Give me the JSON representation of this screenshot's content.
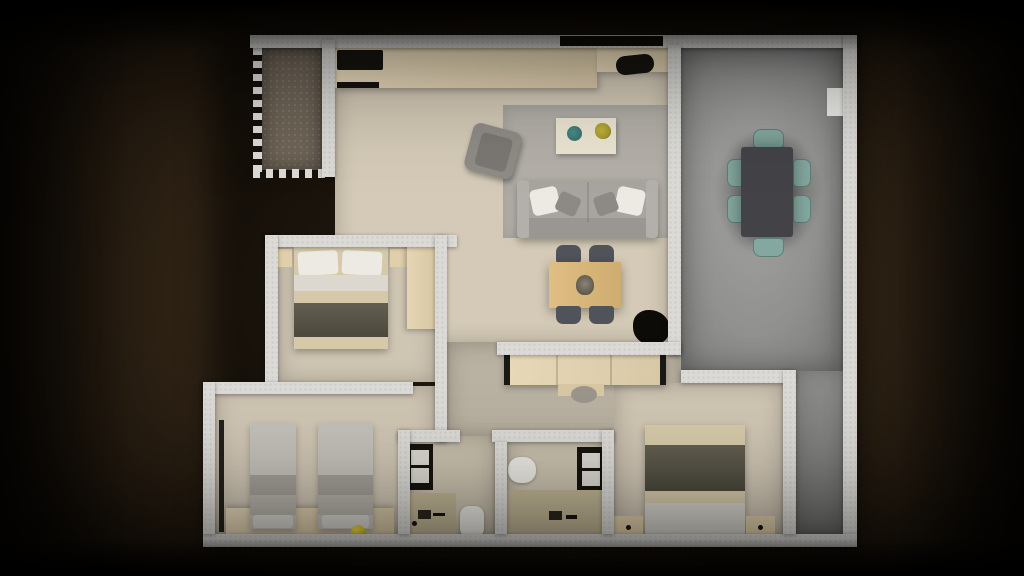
{
  "scene": {
    "title": "Top-down 3D rendered apartment floor plan on a dark brown background",
    "view": "top-down",
    "visible_text": "none"
  },
  "colors": {
    "wall": "#dbdad6",
    "floor_living": "#d4cab7",
    "floor_bedroom": "#cfc5b3",
    "floor_hall": "#b9b1a1",
    "floor_bath": "#c9c0ad",
    "floor_terrace": "#919190",
    "floor_balcony": "#6e6457",
    "counter_wood": "#ead9b6",
    "closet_wood": "#e5d4b0",
    "wardrobe_wood": "#e2d1ac",
    "nightstand_wood": "#e0cfaa",
    "sofa_gray": "#a8a5a0",
    "rug_gray": "#b3afa8",
    "armchair_gray": "#8f8c87",
    "coffee_table_cream": "#ece5d3",
    "plate_teal": "#2e6b66",
    "plant_yellow": "#a89b2d",
    "wood_table": "#dcb776",
    "chair_dark": "#50535a",
    "terrace_table_dark": "#434347",
    "terrace_chair_teal": "#84a89f",
    "blanket_olive": "#565244",
    "bedding_beige": "#d5c9a9",
    "bedding_white": "#dcd8cf",
    "pillow_white": "#edeae3",
    "twin_bed_gray": "#c3c0b9",
    "twin_band_gray": "#a39f98",
    "vanity_green": "#c0b594",
    "fixture_dark": "#17140f",
    "porcelain_white": "#eae8e2",
    "ball_yellow": "#d9c41c",
    "plant_dark": "#0d0b08",
    "pillar_white": "#e8e8e4"
  },
  "rooms": [
    {
      "id": "balcony",
      "label": "Balcony"
    },
    {
      "id": "kitchen",
      "label": "Kitchen"
    },
    {
      "id": "living-room",
      "label": "Living Room"
    },
    {
      "id": "dining-terrace",
      "label": "Dining Terrace"
    },
    {
      "id": "bedroom-1",
      "label": "Bedroom 1"
    },
    {
      "id": "twin-bedroom",
      "label": "Twin Bedroom"
    },
    {
      "id": "hallway",
      "label": "Hallway"
    },
    {
      "id": "bathroom-1",
      "label": "Bathroom 1"
    },
    {
      "id": "bathroom-2",
      "label": "Bathroom 2"
    },
    {
      "id": "master-bedroom",
      "label": "Master Bedroom"
    }
  ],
  "furniture": {
    "kitchen": [
      "counter",
      "cooktop",
      "sink"
    ],
    "living_room": [
      "rug",
      "sofa",
      "throw-pillows",
      "armchair",
      "coffee-table",
      "teal-plate",
      "potted-plant",
      "small-dining-table",
      "four-chairs",
      "floor-plant"
    ],
    "dining_terrace": [
      "dining-table",
      "six-teal-chairs",
      "wall-column"
    ],
    "bedroom_1": [
      "double-bed",
      "two-nightstands",
      "wardrobe"
    ],
    "twin_bedroom": [
      "twin-bed-left",
      "twin-bed-right",
      "dresser",
      "floor-lamp",
      "yellow-ball"
    ],
    "hallway": [
      "closet",
      "stool"
    ],
    "bathroom_1": [
      "shower",
      "vanity",
      "toilet"
    ],
    "bathroom_2": [
      "shower",
      "vanity",
      "washbasin"
    ],
    "master_bedroom": [
      "double-bed",
      "two-nightstands"
    ]
  }
}
